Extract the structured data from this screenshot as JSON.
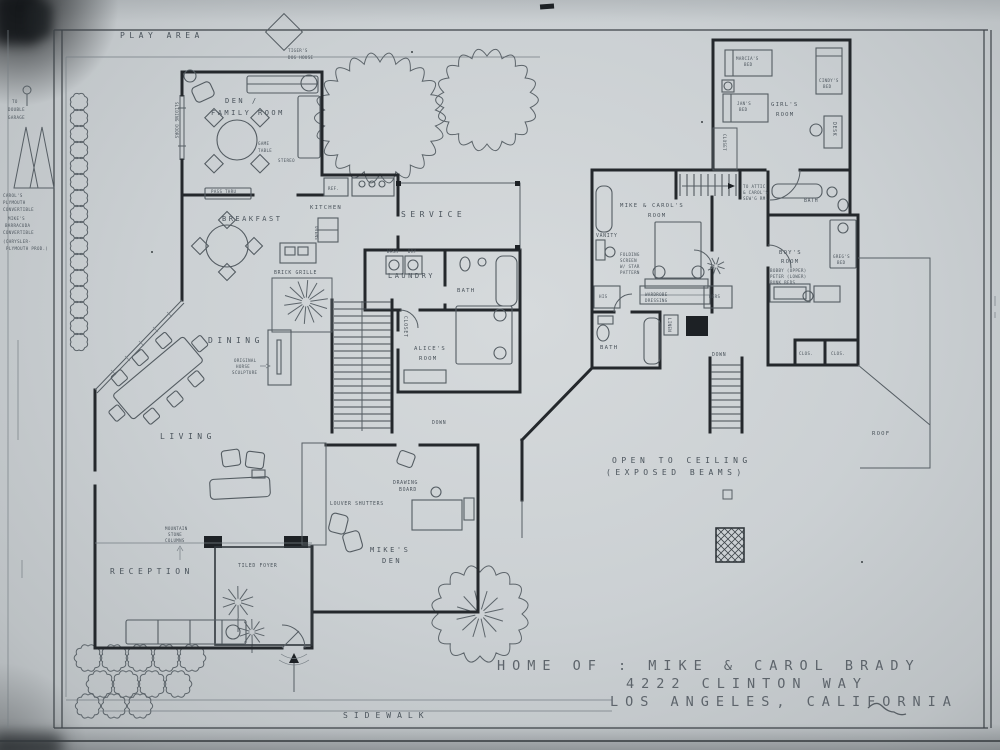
{
  "title_block": {
    "line1": "HOME OF : MIKE & CAROL BRADY",
    "line2": "4222 CLINTON  WAY",
    "line3": "LOS ANGELES, CALIFORNIA"
  },
  "site": {
    "play_area": "PLAY  AREA",
    "doghouse_lines": [
      "TIGER'S",
      "DOG HOUSE"
    ],
    "sidewalk": "SIDEWALK"
  },
  "margin": {
    "garage_note_lines": [
      "TO",
      "DOUBLE",
      "GARAGE"
    ],
    "carol_car_lines": [
      "CAROL'S",
      "PLYMOUTH",
      "CONVERTIBLE"
    ],
    "mike_car_lines": [
      "MIKE'S",
      "BARRACUDA",
      "CONVERTIBLE"
    ],
    "maker_note_lines": [
      "(CHRYSLER-",
      "PLYMOUTH PROD.)"
    ]
  },
  "first_floor": {
    "den_lines": [
      "DEN /",
      "FAMILY ROOM"
    ],
    "game_table_lines": [
      "GAME",
      "TABLE"
    ],
    "stereo": "STEREO",
    "sliding_doors": "SLIDING DOORS",
    "pass_thru": "PASS THRU",
    "ref": "REF.",
    "breakfast": "BREAKFAST",
    "kitchen": "KITCHEN",
    "ovens": "OVENS",
    "grille": "BRICK GRILLE",
    "service": "SERVICE",
    "laundry": "LAUNDRY",
    "wash": "WASH",
    "dry": "DRY",
    "bath": "BATH",
    "alice_lines": [
      "ALICE'S",
      "ROOM"
    ],
    "closet": "CLOSET",
    "dining": "DINING",
    "sculpture_lines": [
      "ORIGINAL",
      "HORSE",
      "SCULPTURE"
    ],
    "living": "LIVING",
    "louver_shutters": "LOUVER SHUTTERS",
    "drawing_board_lines": [
      "DRAWING",
      "BOARD"
    ],
    "mikes_den_lines": [
      "MIKE'S",
      "DEN"
    ],
    "reception": "RECEPTION",
    "column_note_lines": [
      "MOUNTAIN",
      "STONE",
      "COLUMNS"
    ],
    "foyer": "TILED FOYER",
    "down": "DOWN"
  },
  "second_floor": {
    "master_lines": [
      "MIKE & CAROL'S",
      "ROOM"
    ],
    "vanity": "VANITY",
    "screen_note_lines": [
      "FOLDING",
      "SCREEN",
      "W/ STAR",
      "PATTERN"
    ],
    "wardrobe": "WARDROBE",
    "dressing": "DRESSING",
    "his": "HIS",
    "hers": "HERS",
    "bath": "BATH",
    "shared_bath": "BATH",
    "linen": "LINEN",
    "attic_note_lines": [
      "TO ATTIC",
      "& CAROL'S",
      "SEW'G RM."
    ],
    "girls_room_lines": [
      "GIRL'S",
      "ROOM"
    ],
    "marcia_lines": [
      "MARCIA'S",
      "BED"
    ],
    "jan_lines": [
      "JAN'S",
      "BED"
    ],
    "cindy_lines": [
      "CINDY'S",
      "BED"
    ],
    "desk": "DESK",
    "closet": "CLOSET",
    "boys_room_lines": [
      "BOY'S",
      "ROOM"
    ],
    "bunk_note_lines": [
      "BOBBY (UPPER)",
      "PETER (LOWER)",
      "BUNK BEDS"
    ],
    "greg_lines": [
      "GREG'S",
      "BED"
    ],
    "clos1": "CLOS.",
    "clos2": "CLOS.",
    "down": "DOWN",
    "open_ceiling_lines": [
      "OPEN  TO  CEILING",
      "(EXPOSED   BEAMS)"
    ],
    "roof": "ROOF"
  }
}
